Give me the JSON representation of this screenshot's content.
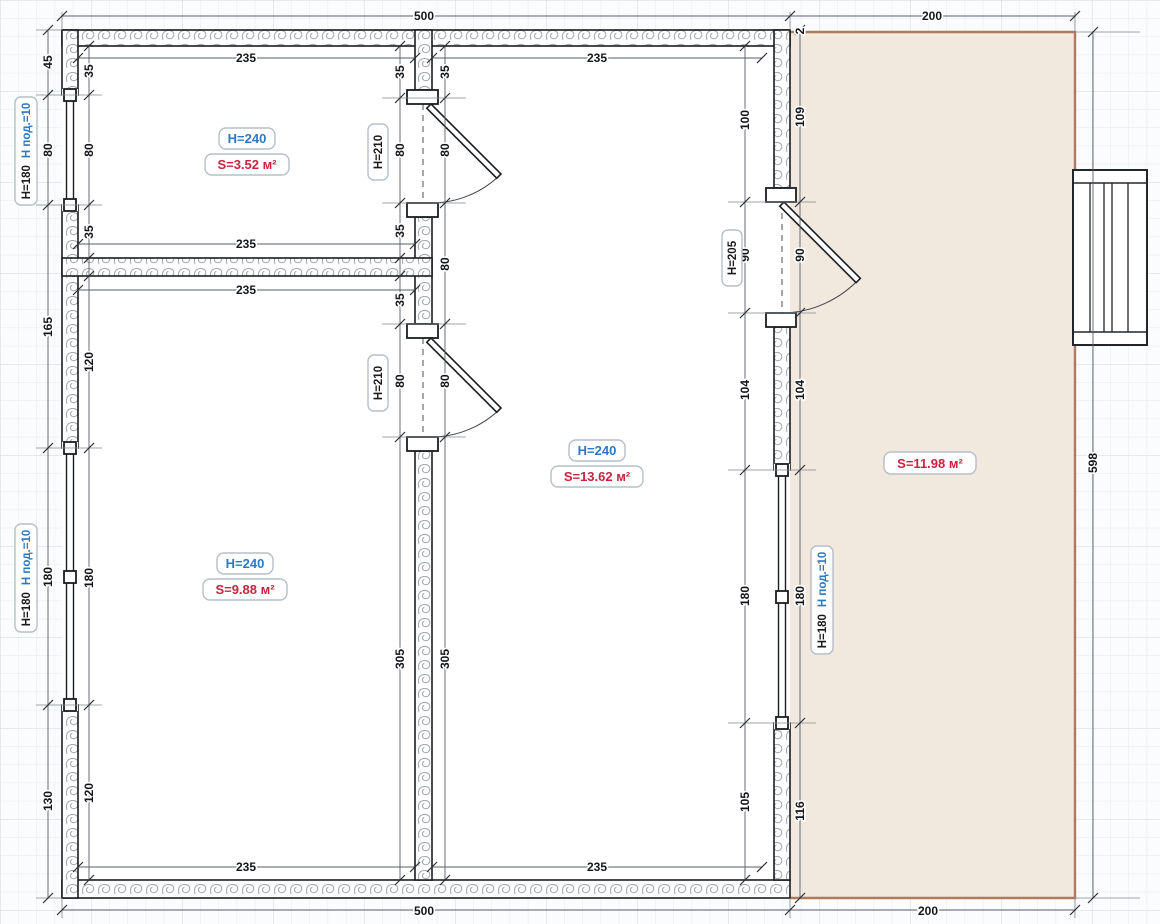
{
  "plan": {
    "rooms": [
      {
        "id": "room-top-left",
        "height": "H=240",
        "area": "S=3.52 м²"
      },
      {
        "id": "room-bottom-left",
        "height": "H=240",
        "area": "S=9.88 м²"
      },
      {
        "id": "room-middle",
        "height": "H=240",
        "area": "S=13.62 м²"
      },
      {
        "id": "terrace",
        "area": "S=11.98 м²"
      }
    ],
    "doors": [
      {
        "label": "H=210"
      },
      {
        "label": "H=210"
      },
      {
        "label": "H=205"
      }
    ],
    "windows": [
      {
        "h": "H=180",
        "sill": "H под.=10"
      },
      {
        "h": "H=180",
        "sill": "H под.=10"
      },
      {
        "h": "H=180",
        "sill": "H под.=10"
      }
    ],
    "dims": {
      "top": [
        "500",
        "200"
      ],
      "bottom": [
        "500",
        "200"
      ],
      "side_total": "598",
      "left_outer": [
        "45",
        "80",
        "165",
        "180",
        "130"
      ],
      "left_inner": [
        "35",
        "80",
        "35",
        "120",
        "180",
        "120"
      ],
      "mid_left": [
        "35",
        "80",
        "35",
        "35",
        "80",
        "305"
      ],
      "mid_right": [
        "35",
        "80",
        "80",
        "80",
        "305"
      ],
      "right_inner": [
        "100",
        "90",
        "104",
        "180",
        "105"
      ],
      "right_outer": [
        "2",
        "109",
        "90",
        "104",
        "180",
        "116"
      ],
      "widths": [
        "235",
        "235",
        "235",
        "235",
        "235",
        "235"
      ]
    },
    "colors": {
      "accent_blue": "#2e78c2",
      "accent_red": "#c9243f",
      "terrace_fill": "#f1e8de",
      "terrace_border": "#b07a5e",
      "wall_hatch_stroke": "#a2a7ad",
      "grid_line": "#e7eaee"
    }
  }
}
